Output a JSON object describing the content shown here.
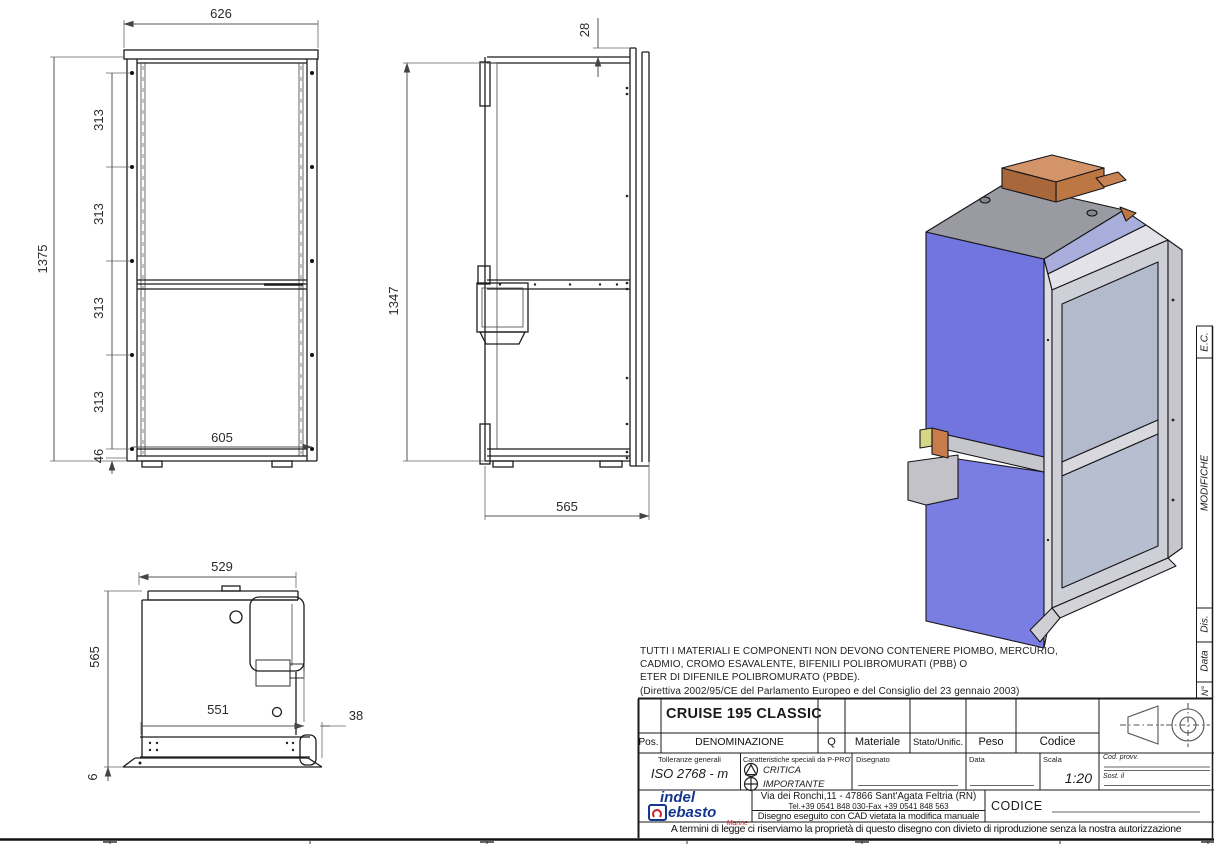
{
  "drawing": {
    "front": {
      "w_top": "626",
      "seg1": "313",
      "seg2": "313",
      "seg3": "313",
      "seg4": "313",
      "h_total": "1375",
      "w_inner": "605",
      "bottom": "46"
    },
    "side": {
      "top": "28",
      "height": "1347",
      "depth": "565"
    },
    "plan": {
      "w_top": "529",
      "depth": "565",
      "w_inner": "551",
      "right": "38",
      "flange": "6"
    }
  },
  "material_note": {
    "line1": "TUTTI I MATERIALI E COMPONENTI NON DEVONO CONTENERE PIOMBO, MERCURIO,",
    "line2": "CADMIO, CROMO ESAVALENTE, BIFENILI POLIBROMURATI (PBB) O",
    "line3": "ETER DI DIFENILE POLIBROMURATO (PBDE).",
    "line4": "(Direttiva 2002/95/CE del Parlamento Europeo e del Consiglio del 23 gennaio 2003)"
  },
  "revision_strip": {
    "ec": "E.C.",
    "modifiche": "MODIFICHE",
    "dis": "Dis.",
    "data": "Data",
    "num": "N°"
  },
  "title_block": {
    "product_name": "CRUISE 195 CLASSIC",
    "pos": "Pos.",
    "denominazione": "DENOMINAZIONE",
    "q": "Q",
    "materiale": "Materiale",
    "stato": "Stato/Unific.",
    "peso": "Peso",
    "codice": "Codice",
    "tolleranze_label": "Tolleranze generali",
    "tolleranze_value": "ISO 2768 - m",
    "caratteristiche_label": "Caratteristiche speciali da P-PROT",
    "critica": "CRITICA",
    "importante": "IMPORTANTE",
    "disegnato": "Disegnato",
    "data": "Data",
    "scala_label": "Scala",
    "scala_value": "1:20",
    "cod_provv": "Cod. provv.",
    "sost": "Sost. il",
    "logo_line1": "indel",
    "logo_line2": "ebasto",
    "logo_line3": "Marine",
    "address1": "Via dei Ronchi,11 - 47866 Sant'Agata Feltria (RN)",
    "address2": "Tel.+39 0541 848 030-Fax +39 0541 848 563",
    "cad_note": "Disegno eseguito con CAD vietata la modifica manuale",
    "codice_label": "CODICE",
    "legal": "A termini di legge ci riserviamo la proprietà di questo disegno con divieto di riproduzione senza la nostra autorizzazione"
  },
  "colors": {
    "render_side_blue": "#7a7ee2",
    "render_door_gray": "#b4bccd",
    "render_top_gray": "#9a9aa2",
    "render_compressor_orange": "#c87c4c",
    "render_rim_lavender": "#a8adda",
    "logo_blue": "#16368e",
    "logo_red": "#cc2222"
  }
}
